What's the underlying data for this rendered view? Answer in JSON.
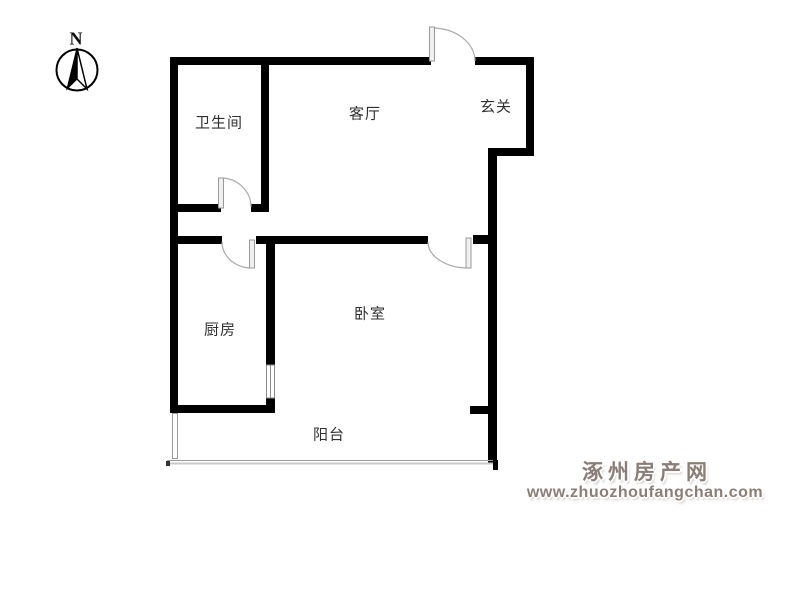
{
  "compass": {
    "north_label": "N"
  },
  "rooms": {
    "bathroom": {
      "label": "卫生间"
    },
    "living_room": {
      "label": "客厅"
    },
    "entry": {
      "label": "玄关"
    },
    "kitchen": {
      "label": "厨房"
    },
    "bedroom": {
      "label": "卧室"
    },
    "balcony": {
      "label": "阳台"
    }
  },
  "watermark": {
    "site_name": "涿州房产网",
    "site_url": "www.zhuozhoufangchan.com"
  },
  "colors": {
    "wall": "#000000",
    "door_arc": "#aaaaaa",
    "door_leaf_fill": "#f0f0f0",
    "window_line": "#999999",
    "label_text": "#303030",
    "watermark": "#8a7e76",
    "background": "#ffffff"
  }
}
